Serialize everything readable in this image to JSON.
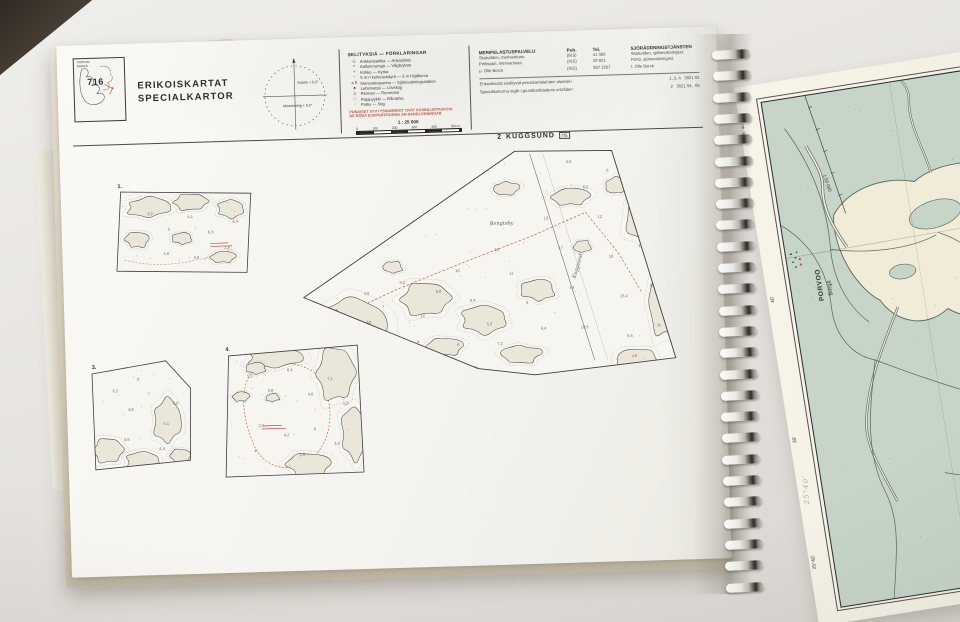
{
  "left_page": {
    "index_box": {
      "number": "716",
      "region_top": "PORVOO",
      "region_bottom": "BORGÅ"
    },
    "title_fi": "ERIKOISKARTAT",
    "title_sv": "SPECIALKARTOR",
    "compass": {
      "top_label": "Eranto + 5,5°",
      "bottom_label": "Missvisning + 5,5°"
    },
    "legend": {
      "title": "SELITYKSIÄ — FÖRKLARINGAR",
      "items": [
        {
          "sym": "⚓",
          "text": "Ankkuripaikka — Ankarplats"
        },
        {
          "sym": "≈",
          "text": "Aallonmurtaja — Vågbrytare"
        },
        {
          "sym": "+",
          "text": "Kirkko — Kyrka"
        },
        {
          "sym": "~",
          "text": "5 m:n korkeuskäyrä — 5 m höjdkurva"
        },
        {
          "sym": "a R",
          "text": "Merivartioasema — Sjöbevakningsstation"
        },
        {
          "sym": "♣",
          "text": "Lehtimetsä — Lövskog"
        },
        {
          "sym": "△",
          "text": "Reimari — Remmare"
        },
        {
          "sym": "□",
          "text": "Rajapyykki — Råmärke"
        },
        {
          "sym": "···",
          "text": "Polku — Stig"
        }
      ],
      "red_note_1": "PUNAISET SYVYYSNUMEROT OVAT KÄSINLUOTAUKSIA",
      "red_note_2": "DE RÖDA DJUPSIFFRORNA ÄR HANDLODNINGAR",
      "scale_label": "1 : 25 000",
      "scale_ticks": [
        "0",
        "100",
        "200",
        "300",
        "400",
        "500 m"
      ]
    },
    "contacts": {
      "col_fi": "MERIPELASTUSPALVELU",
      "col_puh": "Puh.",
      "col_tel": "Tel.",
      "col_sv": "SJÖRÄDDNINGSTJÄNSTEN",
      "rows": [
        {
          "fi": "Skatudden, merivartioas.",
          "puh": "(915)",
          "tel": "41 366",
          "sv": "Skatudden, sjöbevakningsst."
        },
        {
          "fi": "Pirttisaari, merivartioas.",
          "puh": "(915)",
          "tel": "29 821",
          "sv": "Pörtö, sjöbevakningsst."
        },
        {
          "fi": "p. Olle Borck",
          "puh": "(915)",
          "tel": "397 2267",
          "sv": "t. Olle Borck"
        }
      ],
      "note_rows": [
        {
          "text": "Erikoiskartat sisältyvät peruskarttalehtien alueisiin",
          "ref": "1, 3, 4   3021 01"
        },
        {
          "text": "Specialkartorna ingår i grundkartbladens områden",
          "ref": "2   3021 04,  05"
        }
      ]
    },
    "charts": {
      "main_title": {
        "number": "2",
        "name": "KUGGSUND",
        "ref": "7/5"
      },
      "inset_labels": [
        "1.",
        "3.",
        "4."
      ],
      "place_labels": [
        {
          "text": "Emäsalo",
          "x": 286,
          "y": 196,
          "rot": -14
        },
        {
          "text": "Kuggsund",
          "x": 512,
          "y": 152,
          "rot": -72
        },
        {
          "text": "Bengtsby",
          "x": 428,
          "y": 96,
          "rot": 0
        }
      ],
      "depths_main": [
        {
          "x": 268,
          "y": 178,
          "v": "2,8"
        },
        {
          "x": 300,
          "y": 162,
          "v": "4,6"
        },
        {
          "x": 318,
          "y": 176,
          "v": "7"
        },
        {
          "x": 336,
          "y": 152,
          "v": "9,2"
        },
        {
          "x": 356,
          "y": 186,
          "v": "12"
        },
        {
          "x": 372,
          "y": 162,
          "v": "6,8"
        },
        {
          "x": 392,
          "y": 142,
          "v": "10"
        },
        {
          "x": 406,
          "y": 172,
          "v": "8,4"
        },
        {
          "x": 422,
          "y": 196,
          "v": "5,2"
        },
        {
          "x": 432,
          "y": 122,
          "v": "15"
        },
        {
          "x": 446,
          "y": 146,
          "v": "11"
        },
        {
          "x": 462,
          "y": 176,
          "v": "9"
        },
        {
          "x": 476,
          "y": 202,
          "v": "6,4"
        },
        {
          "x": 482,
          "y": 92,
          "v": "13"
        },
        {
          "x": 496,
          "y": 122,
          "v": "17"
        },
        {
          "x": 506,
          "y": 162,
          "v": "14"
        },
        {
          "x": 516,
          "y": 202,
          "v": "10,6"
        },
        {
          "x": 522,
          "y": 62,
          "v": "8,2"
        },
        {
          "x": 536,
          "y": 92,
          "v": "12"
        },
        {
          "x": 546,
          "y": 132,
          "v": "16"
        },
        {
          "x": 556,
          "y": 172,
          "v": "13,4"
        },
        {
          "x": 562,
          "y": 212,
          "v": "9,6"
        },
        {
          "x": 576,
          "y": 122,
          "v": "18"
        },
        {
          "x": 586,
          "y": 162,
          "v": "15"
        },
        {
          "x": 592,
          "y": 202,
          "v": "11"
        },
        {
          "x": 352,
          "y": 212,
          "v": "4"
        },
        {
          "x": 392,
          "y": 216,
          "v": "6"
        },
        {
          "x": 432,
          "y": 216,
          "v": "7,2"
        },
        {
          "x": 506,
          "y": 36,
          "v": "5,6"
        },
        {
          "x": 546,
          "y": 46,
          "v": "9"
        },
        {
          "x": 566,
          "y": 232,
          "v": "4,8",
          "r": true
        },
        {
          "x": 592,
          "y": 240,
          "v": "3,6",
          "r": true
        }
      ],
      "depths_inset1": [
        {
          "x": 86,
          "y": 76,
          "v": "3,2"
        },
        {
          "x": 106,
          "y": 92,
          "v": "5"
        },
        {
          "x": 126,
          "y": 80,
          "v": "4,1"
        },
        {
          "x": 146,
          "y": 96,
          "v": "6,3"
        },
        {
          "x": 162,
          "y": 112,
          "v": "2,8"
        },
        {
          "x": 101,
          "y": 116,
          "v": "4,6"
        },
        {
          "x": 131,
          "y": 121,
          "v": "3,9"
        },
        {
          "x": 171,
          "y": 86,
          "v": "5,4",
          "r": true
        }
      ],
      "depths_inset3": [
        {
          "x": 46,
          "y": 252,
          "v": "6,2"
        },
        {
          "x": 61,
          "y": 271,
          "v": "4,8"
        },
        {
          "x": 81,
          "y": 256,
          "v": "7"
        },
        {
          "x": 96,
          "y": 286,
          "v": "5,1"
        },
        {
          "x": 56,
          "y": 301,
          "v": "3,6"
        },
        {
          "x": 91,
          "y": 311,
          "v": "4,4"
        },
        {
          "x": 71,
          "y": 241,
          "v": "8"
        },
        {
          "x": 106,
          "y": 266,
          "v": "6,6"
        }
      ],
      "depths_inset4": [
        {
          "x": 181,
          "y": 241,
          "v": "5,2"
        },
        {
          "x": 201,
          "y": 256,
          "v": "3,8"
        },
        {
          "x": 221,
          "y": 236,
          "v": "6,4"
        },
        {
          "x": 241,
          "y": 261,
          "v": "4,6"
        },
        {
          "x": 261,
          "y": 246,
          "v": "7,1"
        },
        {
          "x": 276,
          "y": 271,
          "v": "5,8"
        },
        {
          "x": 191,
          "y": 291,
          "v": "2,9",
          "r": true
        },
        {
          "x": 216,
          "y": 301,
          "v": "4,2"
        },
        {
          "x": 246,
          "y": 296,
          "v": "6"
        },
        {
          "x": 266,
          "y": 311,
          "v": "3,4"
        },
        {
          "x": 231,
          "y": 321,
          "v": "5,6"
        },
        {
          "x": 186,
          "y": 316,
          "v": "4"
        }
      ]
    }
  },
  "right_page": {
    "corner_top": "25°40'",
    "tick_40": "40'",
    "tick_35": "35'",
    "corner_bottom": "25°40'",
    "scale_label": "1:50 000",
    "city_fi": "PORVOO",
    "city_sv": "Borgå",
    "pencil_note": "25°40'"
  }
}
